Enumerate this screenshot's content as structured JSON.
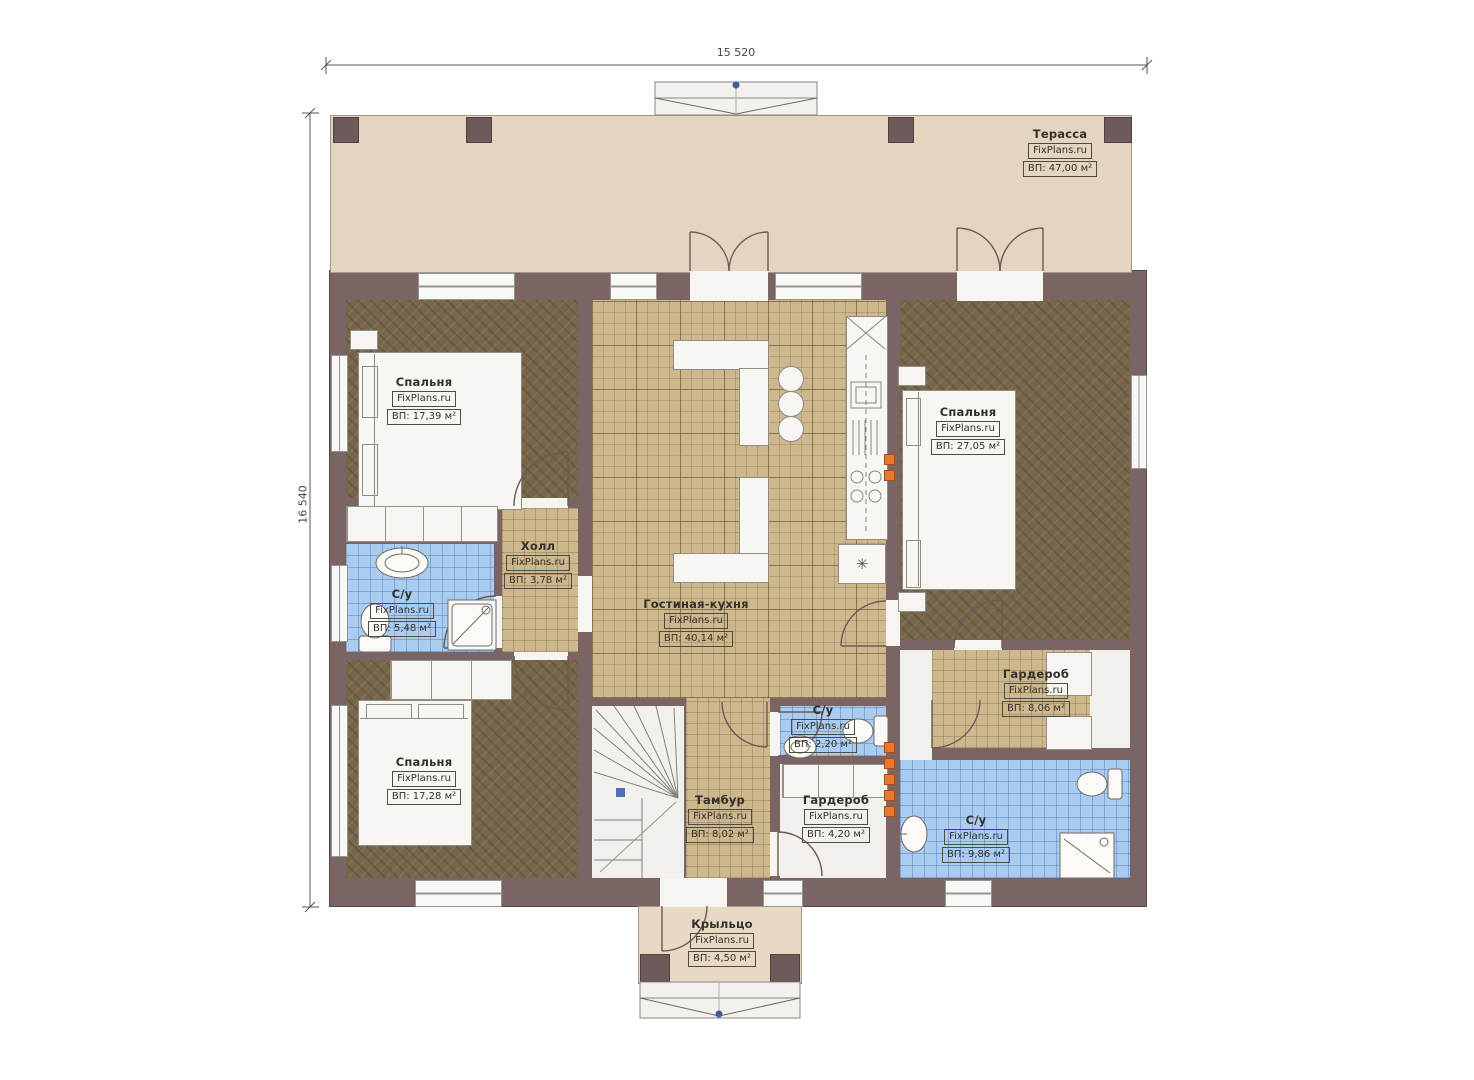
{
  "watermark": "FixPlans.ru",
  "dimensions": {
    "top": "15 520",
    "left": "16 540"
  },
  "rooms": [
    {
      "name": "Терасса",
      "area": "ВП: 47,00 м²"
    },
    {
      "name": "Спальня",
      "area": "ВП: 17,39 м²"
    },
    {
      "name": "С/у",
      "area": "ВП: 5,48 м²"
    },
    {
      "name": "Холл",
      "area": "ВП: 3,78 м²"
    },
    {
      "name": "Спальня",
      "area": "ВП: 17,28 м²"
    },
    {
      "name": "Гостиная-кухня",
      "area": "ВП: 40,14 м²"
    },
    {
      "name": "Спальня",
      "area": "ВП: 27,05 м²"
    },
    {
      "name": "Гардероб",
      "area": "ВП: 8,06 м²"
    },
    {
      "name": "С/у",
      "area": "ВП: 2,20 м²"
    },
    {
      "name": "Тамбур",
      "area": "ВП: 8,02 м²"
    },
    {
      "name": "Гардероб",
      "area": "ВП: 4,20 м²"
    },
    {
      "name": "С/у",
      "area": "ВП: 9,86 м²"
    },
    {
      "name": "Крыльцо",
      "area": "ВП: 4,50 м²"
    }
  ],
  "icons": {
    "washer": "✳"
  },
  "colors": {
    "wall": "#7a6464",
    "terrace": "#e3d5bf",
    "tan_tile": "#cdb88e",
    "blue_tile": "#a9ccf0",
    "dark_floor": "#77674a",
    "white_floor": "#f1f0ed",
    "accent_orange": "#e8762c",
    "marker_blue": "#4a6fb5"
  }
}
